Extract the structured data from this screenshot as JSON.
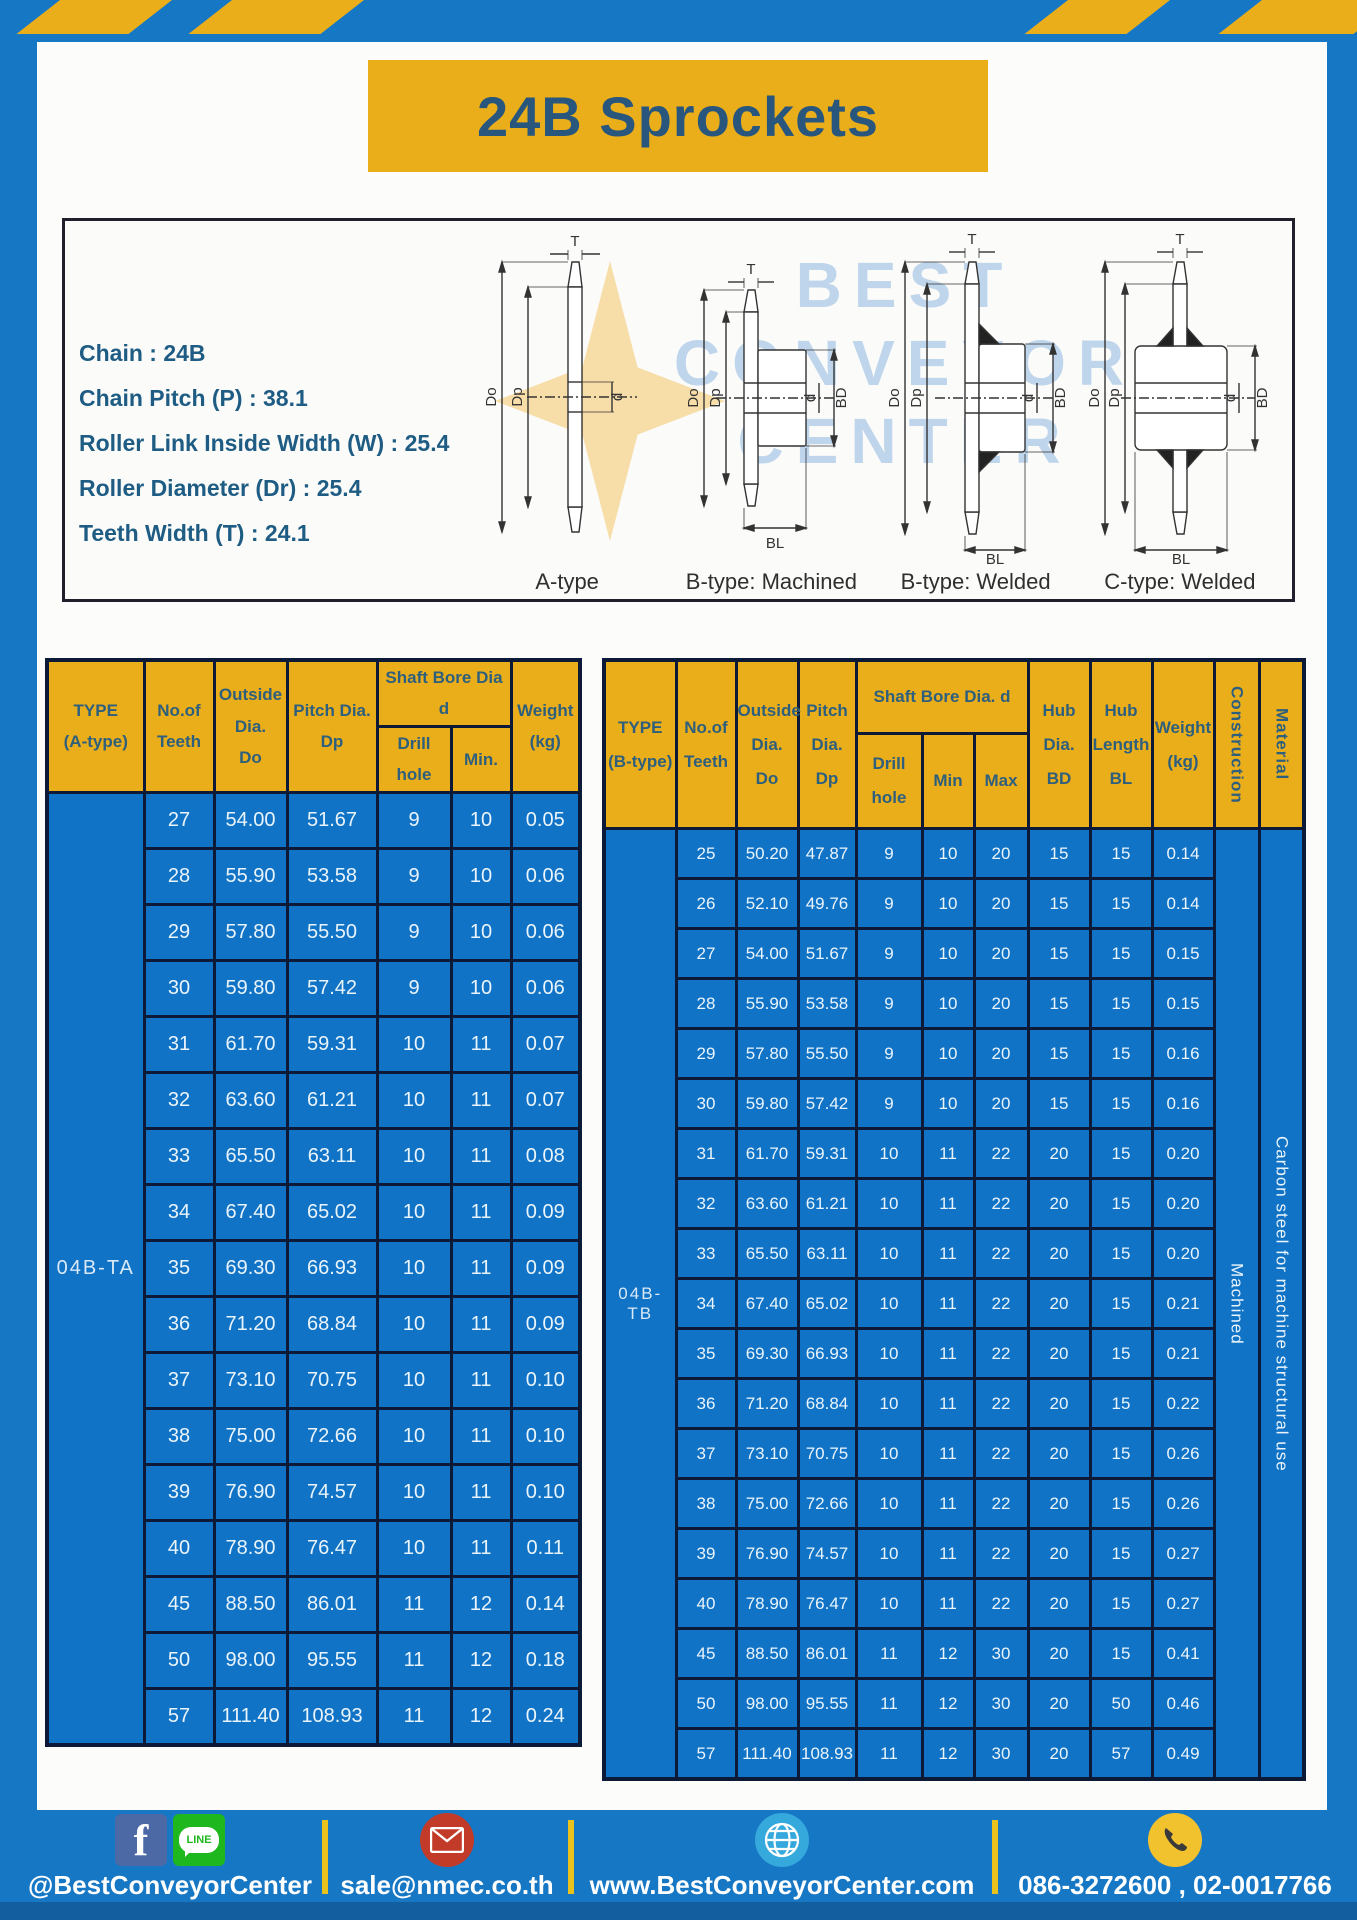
{
  "page": {
    "title": "24B Sprockets"
  },
  "specs": {
    "lines": [
      "Chain : 24B",
      "Chain Pitch (P) : 38.1",
      "Roller Link Inside Width (W) : 25.4",
      "Roller Diameter (Dr) : 25.4",
      "Teeth Width (T) : 24.1"
    ]
  },
  "diagrams": {
    "watermark": "BEST\nCONVEYOR\nCENTER",
    "captions": [
      "A-type",
      "B-type: Machined",
      "B-type: Welded",
      "C-type: Welded"
    ],
    "dim_labels": {
      "t": "T",
      "do": "Do",
      "dp": "Dp",
      "d": "d",
      "bd": "BD",
      "bl": "BL"
    }
  },
  "table_a": {
    "type_label": "04B-TA",
    "headers": {
      "type": "TYPE\n(A-type)",
      "teeth": "No.of\nTeeth",
      "outside": "Outside\nDia.\nDo",
      "pitch": "Pitch Dia.\nDp",
      "shaft_group": "Shaft Bore Dia d",
      "drill": "Drill hole",
      "min": "Min.",
      "weight": "Weight\n(kg)"
    },
    "rows": [
      [
        "27",
        "54.00",
        "51.67",
        "9",
        "10",
        "0.05"
      ],
      [
        "28",
        "55.90",
        "53.58",
        "9",
        "10",
        "0.06"
      ],
      [
        "29",
        "57.80",
        "55.50",
        "9",
        "10",
        "0.06"
      ],
      [
        "30",
        "59.80",
        "57.42",
        "9",
        "10",
        "0.06"
      ],
      [
        "31",
        "61.70",
        "59.31",
        "10",
        "11",
        "0.07"
      ],
      [
        "32",
        "63.60",
        "61.21",
        "10",
        "11",
        "0.07"
      ],
      [
        "33",
        "65.50",
        "63.11",
        "10",
        "11",
        "0.08"
      ],
      [
        "34",
        "67.40",
        "65.02",
        "10",
        "11",
        "0.09"
      ],
      [
        "35",
        "69.30",
        "66.93",
        "10",
        "11",
        "0.09"
      ],
      [
        "36",
        "71.20",
        "68.84",
        "10",
        "11",
        "0.09"
      ],
      [
        "37",
        "73.10",
        "70.75",
        "10",
        "11",
        "0.10"
      ],
      [
        "38",
        "75.00",
        "72.66",
        "10",
        "11",
        "0.10"
      ],
      [
        "39",
        "76.90",
        "74.57",
        "10",
        "11",
        "0.10"
      ],
      [
        "40",
        "78.90",
        "76.47",
        "10",
        "11",
        "0.11"
      ],
      [
        "45",
        "88.50",
        "86.01",
        "11",
        "12",
        "0.14"
      ],
      [
        "50",
        "98.00",
        "95.55",
        "11",
        "12",
        "0.18"
      ],
      [
        "57",
        "111.40",
        "108.93",
        "11",
        "12",
        "0.24"
      ]
    ]
  },
  "table_b": {
    "type_label": "04B-TB",
    "construction": "Machined",
    "material": "Carbon steel for machine structural use",
    "headers": {
      "type": "TYPE\n(B-type)",
      "teeth": "No.of\nTeeth",
      "outside": "Outside\nDia.\nDo",
      "pitch": "Pitch\nDia.\nDp",
      "shaft_group": "Shaft Bore Dia. d",
      "drill": "Drill hole",
      "min": "Min",
      "max": "Max",
      "hub_dia": "Hub\nDia.\nBD",
      "hub_len": "Hub\nLength\nBL",
      "weight": "Weight\n(kg)",
      "construction": "Construction",
      "material": "Material"
    },
    "rows": [
      [
        "25",
        "50.20",
        "47.87",
        "9",
        "10",
        "20",
        "15",
        "15",
        "0.14"
      ],
      [
        "26",
        "52.10",
        "49.76",
        "9",
        "10",
        "20",
        "15",
        "15",
        "0.14"
      ],
      [
        "27",
        "54.00",
        "51.67",
        "9",
        "10",
        "20",
        "15",
        "15",
        "0.15"
      ],
      [
        "28",
        "55.90",
        "53.58",
        "9",
        "10",
        "20",
        "15",
        "15",
        "0.15"
      ],
      [
        "29",
        "57.80",
        "55.50",
        "9",
        "10",
        "20",
        "15",
        "15",
        "0.16"
      ],
      [
        "30",
        "59.80",
        "57.42",
        "9",
        "10",
        "20",
        "15",
        "15",
        "0.16"
      ],
      [
        "31",
        "61.70",
        "59.31",
        "10",
        "11",
        "22",
        "20",
        "15",
        "0.20"
      ],
      [
        "32",
        "63.60",
        "61.21",
        "10",
        "11",
        "22",
        "20",
        "15",
        "0.20"
      ],
      [
        "33",
        "65.50",
        "63.11",
        "10",
        "11",
        "22",
        "20",
        "15",
        "0.20"
      ],
      [
        "34",
        "67.40",
        "65.02",
        "10",
        "11",
        "22",
        "20",
        "15",
        "0.21"
      ],
      [
        "35",
        "69.30",
        "66.93",
        "10",
        "11",
        "22",
        "20",
        "15",
        "0.21"
      ],
      [
        "36",
        "71.20",
        "68.84",
        "10",
        "11",
        "22",
        "20",
        "15",
        "0.22"
      ],
      [
        "37",
        "73.10",
        "70.75",
        "10",
        "11",
        "22",
        "20",
        "15",
        "0.26"
      ],
      [
        "38",
        "75.00",
        "72.66",
        "10",
        "11",
        "22",
        "20",
        "15",
        "0.26"
      ],
      [
        "39",
        "76.90",
        "74.57",
        "10",
        "11",
        "22",
        "20",
        "15",
        "0.27"
      ],
      [
        "40",
        "78.90",
        "76.47",
        "10",
        "11",
        "22",
        "20",
        "15",
        "0.27"
      ],
      [
        "45",
        "88.50",
        "86.01",
        "11",
        "12",
        "30",
        "20",
        "15",
        "0.41"
      ],
      [
        "50",
        "98.00",
        "95.55",
        "11",
        "12",
        "30",
        "20",
        "50",
        "0.46"
      ],
      [
        "57",
        "111.40",
        "108.93",
        "11",
        "12",
        "30",
        "20",
        "57",
        "0.49"
      ]
    ]
  },
  "footer": {
    "social_label": "@BestConveyorCenter",
    "email_label": "sale@nmec.co.th",
    "web_label": "www.BestConveyorCenter.com",
    "phone_label": "086-3272600 , 02-0017766",
    "line_text": "LINE"
  },
  "colors": {
    "frame_blue": "#1677C5",
    "table_blue": "#1173C5",
    "accent_yellow": "#EAAE1B",
    "border_navy": "#0C1A38",
    "title_blue": "#28567D"
  }
}
